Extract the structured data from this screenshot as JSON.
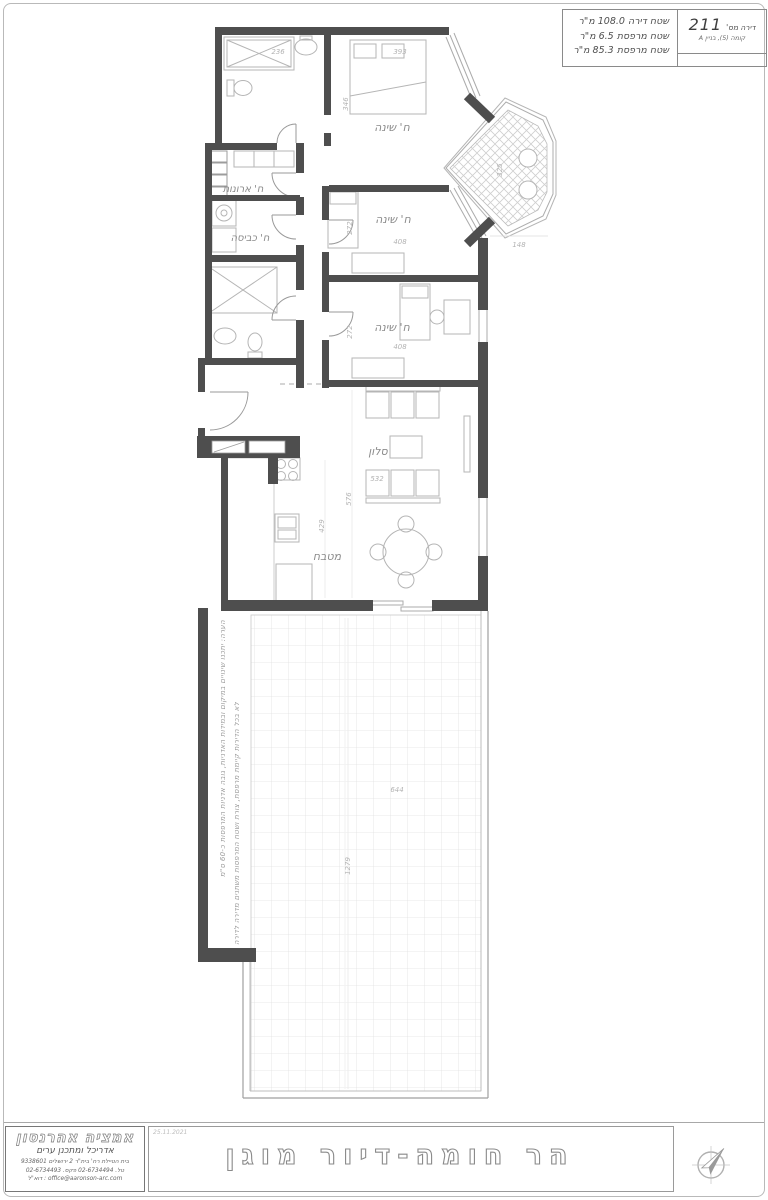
{
  "sheet": {
    "title_block": {
      "apartment_label": "דירה מס'",
      "apartment_number": "211",
      "floor_line": "קומה (5), בניין A",
      "area_line1": "שטח דירה 108.0 מ\"ר",
      "area_line2": "שטח מרפסת 6.5 מ\"ר",
      "area_line3": "שטח מרפסת 85.3 מ\"ר"
    },
    "rooms": {
      "bedroom1": "ח' שינה",
      "bedroom2": "ח' שינה",
      "bedroom3": "ח' שינה",
      "closet": "ח' ארונות",
      "laundry": "ח' כביסה",
      "living": "סלון",
      "kitchen": "מטבח"
    },
    "dims": {
      "bath1_w": "236",
      "bed1_w": "393",
      "bed1_h": "346",
      "bed2_h": "272",
      "bed2_w": "408",
      "bed3_h": "272",
      "bed3_w": "408",
      "bay_h": "325",
      "bay_w": "148",
      "living_w": "532",
      "living_h": "576",
      "kitchen_h": "429",
      "terrace_w": "644",
      "terrace_h": "1279"
    },
    "notes": {
      "line1": "הערה: יתכנו שינויים במיקום ובמידות האדניות, גובה אדניות המרפסות כ-60 ס\"מ",
      "line2": "לא בכל הדירות קיימת מרפסת, צורת ושטח המרפסות משתנים מדירה לדירה"
    },
    "footer": {
      "architect_name": "אמציה אהרנסון",
      "architect_title": "אדריכל ומתכנן ערים",
      "address": "בית הטיילת רח' בית\"ר 2 ירושלים 9338601",
      "phones": "טל. 02-6734494 פקס. 02-6734493",
      "email": "office@aaronson-arc.com : דוא\"ל",
      "date": "25.11.2021",
      "project_title": "הר חומה-דיור מוגן"
    }
  }
}
